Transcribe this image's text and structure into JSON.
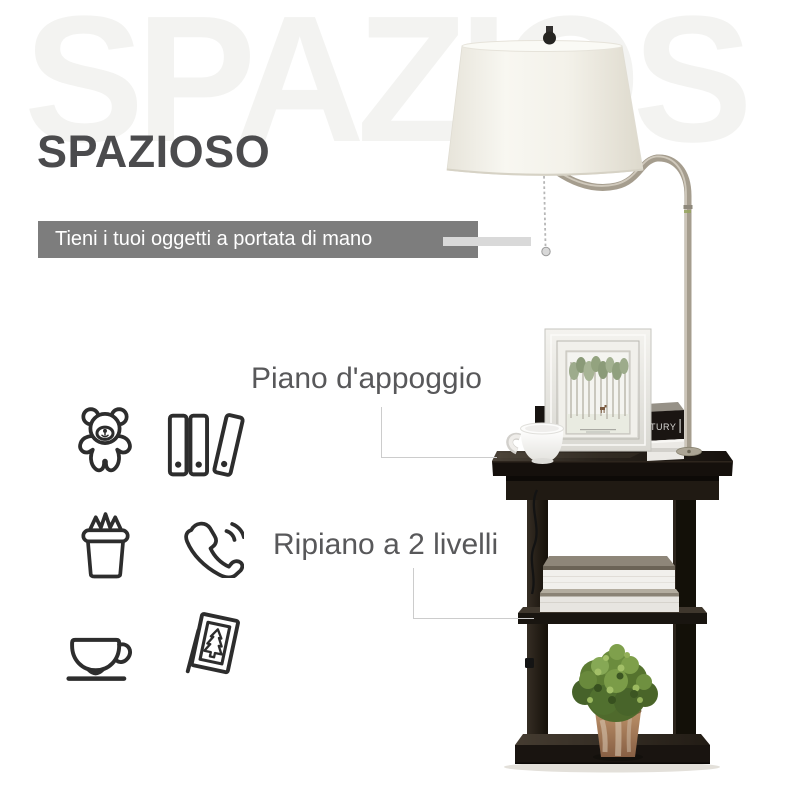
{
  "heading": {
    "watermark": "SPAZIOS",
    "title": "SPAZIOSO"
  },
  "banner": {
    "text": "Tieni i tuoi oggetti a portata di mano"
  },
  "callouts": {
    "surface": {
      "label": "Piano d'appoggio"
    },
    "shelves": {
      "label": "Ripiano a 2 livelli"
    }
  },
  "icons": [
    {
      "name": "teddy-bear-icon"
    },
    {
      "name": "binders-icon"
    },
    {
      "name": "gift-box-icon"
    },
    {
      "name": "phone-icon"
    },
    {
      "name": "coffee-cup-icon"
    },
    {
      "name": "picture-frame-icon"
    }
  ],
  "photo": {
    "book_spine_text": "TURY"
  },
  "colors": {
    "watermark": "#f3f3f1",
    "heading": "#4b4b4d",
    "banner_bg": "#7d7d7d",
    "banner_text": "#ffffff",
    "pointer_bar": "#d9d9d9",
    "callout_text": "#58585a",
    "connector_line": "#cccccc",
    "icon_stroke": "#2d2d2d",
    "table_wood": "#1d1812",
    "lamp_metal": "#a59d8e",
    "lamp_shade": "#f6f4ee",
    "plant_green": "#55722f",
    "pot_terracotta": "#a87f5c"
  }
}
